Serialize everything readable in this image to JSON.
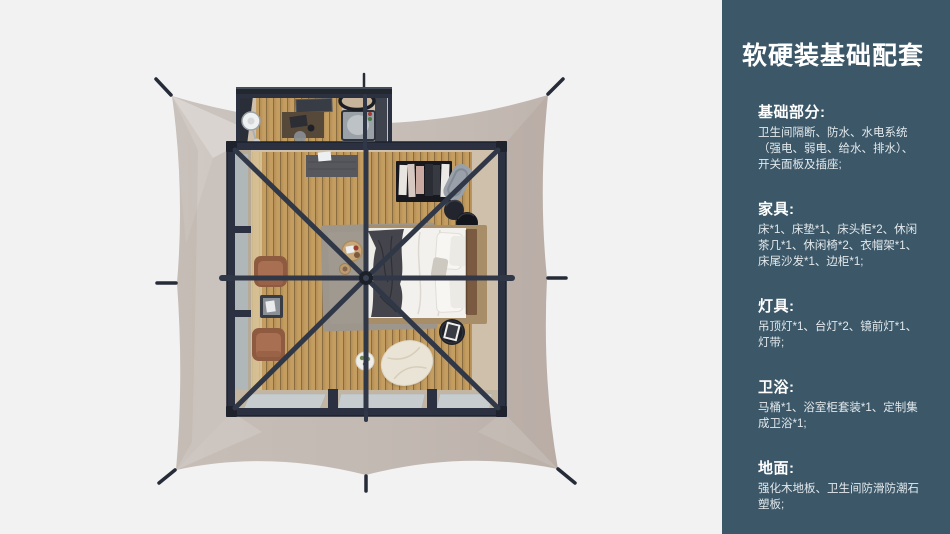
{
  "page": {
    "background": "#f2f2f3"
  },
  "sidebar": {
    "background": "#3b5768",
    "title": "软硬装基础配套",
    "sections": [
      {
        "heading": "基础部分:",
        "body": "卫生间隔断、防水、水电系统\n（强电、弱电、给水、排水）、\n开关面板及插座;"
      },
      {
        "heading": "家具:",
        "body": "床*1、床垫*1、床头柜*2、休闲\n茶几*1、休闲椅*2、衣帽架*1、\n床尾沙发*1、边柜*1;"
      },
      {
        "heading": "灯具:",
        "body": "吊顶灯*1、台灯*2、镜前灯*1、\n灯带;"
      },
      {
        "heading": "卫浴:",
        "body": "马桶*1、浴室柜套装*1、定制集\n成卫浴*1;"
      },
      {
        "heading": "地面:",
        "body": "强化木地板、卫生间防滑防潮石\n塑板;"
      }
    ]
  },
  "floorplan": {
    "scene": "top-down render of a square safari tent: beige guy-roped canvas, dark steel frame room with radial roof beams, bathroom pod at top, bed, leisure chairs, clothes rack, bean bag",
    "colors": {
      "canvas": "#c7beb9",
      "frame": "#2b3140",
      "wood_floor": "#c49d60",
      "floor_border": "#cfc0ac",
      "glass": "#c7cdce",
      "bed": "#f0eeea",
      "throw_blanket": "#44454c",
      "headboard": "#7a5a40",
      "chair": "#a96f52",
      "rug": "#9c968d",
      "bean_bag": "#eae4d6"
    },
    "items": [
      "tent-canvas",
      "guy-stakes",
      "bathroom-pod",
      "shower-tray",
      "basin",
      "vanity-desk",
      "round-mirror-fan",
      "main-room",
      "left-windows",
      "bottom-glass-doors",
      "doorway-mat",
      "clothes-rack",
      "luggage-rack",
      "round-poufs",
      "bed",
      "pillows",
      "throw-blanket",
      "nightstand-table",
      "rug",
      "breakfast-tray",
      "leisure-chair",
      "tea-table",
      "bean-bag-pouf",
      "plant-stool",
      "roof-beams",
      "hub"
    ]
  }
}
